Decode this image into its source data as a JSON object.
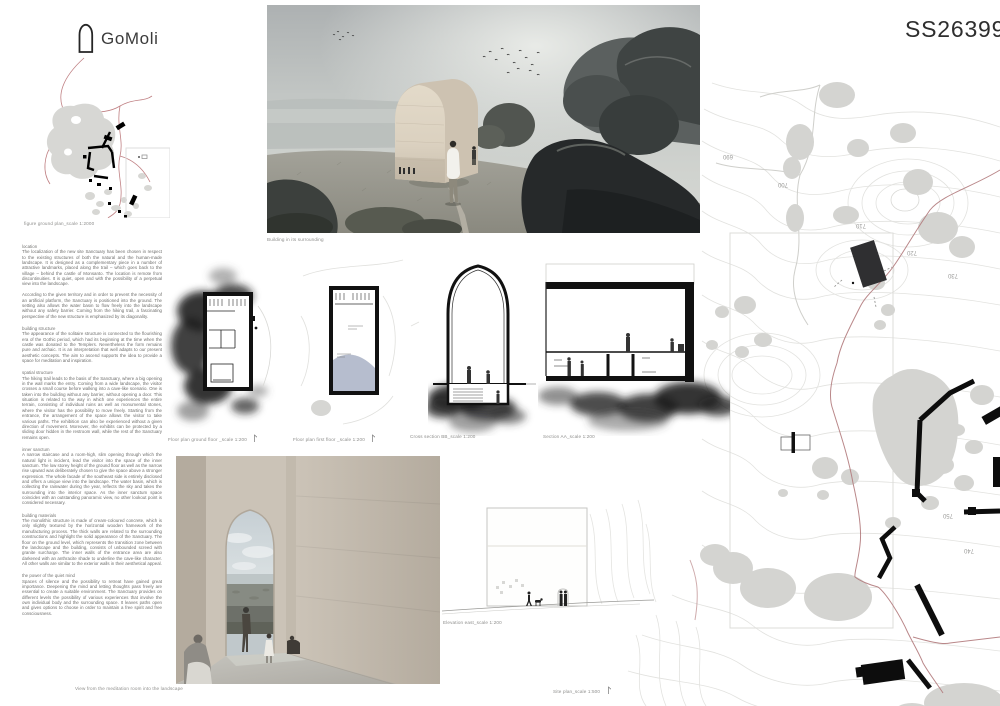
{
  "header": {
    "logo_text": "GoMoli",
    "entry_code": "SS26399"
  },
  "figure_ground": {
    "caption": "figure ground plan_scale 1:2000"
  },
  "main_render": {
    "caption": "Building in its surrounding"
  },
  "interior_render": {
    "caption": "View from the meditation room into the landscape"
  },
  "drawings": {
    "ground_floor_caption": "Floor plan ground floor _scale 1:200",
    "first_floor_caption": "Floor plan first floor _scale 1:200",
    "cross_section_caption": "Cross section BB_scale 1:200",
    "long_section_caption": "Section AA_scale 1:200",
    "elevation_caption": "Elevation east_scale 1:200"
  },
  "site_plan": {
    "caption": "Site plan_scale 1:500",
    "contour_labels": [
      "690",
      "700",
      "710",
      "720",
      "730",
      "740",
      "750"
    ]
  },
  "text_columns": {
    "sections": [
      {
        "heading": "location",
        "body": "The localization of the new site Sanctuary has been chosen in respect to the existing structures of both the natural and the human-made landscape. It is designed as a complementary piece in a number of attractive landmarks, placed along the trail – which goes back to the village – behind the castle of Monsanto. The location is remote from discontinuities. It is quiet, open and with the possibility of a perpetual view into the landscape.\n\nAccording to the given territory and in order to prevent the necessity of an artificial platform, the Sanctuary is positioned into the ground. The setting also allows the water basin to flow freely into the landscape without any safety barrier. Coming from the hiking trail, a fascinating perspective of the new structure is emphasized by its diagonality."
      },
      {
        "heading": "building structure",
        "body": "The appearance of the solitaire structure is connected to the flourishing era of the Gothic period, which had its beginning at the time when the castle was donated to the Templers. Nevertheless the form remains pure and archaic. It is an interpretation that well adapts to our present aesthetic concepts. The aim to ascend supports the idea to provide a space for meditation and inspiration."
      },
      {
        "heading": "spatial structure",
        "body": "The hiking trail leads to the basis of the Sanctuary, where a big opening in the wall marks the entry. Coming from a wide landscape, the visitor crosses a small course before walking into a cave-like scenario. One is taken into the building without any barrier, without opening a door. This situation is related to the way in which one experiences the entire terrain, consisting of individual ruins as well as monumental stones, where the visitor has the possibility to move freely. Starting from the entrance, the arrangement of the space allows the visitor to take various paths. The exhibition can also be experienced without a given direction of movement. Moreover, the exhibits can be protected by a sliding door hidden in the restroom wall, while the rest of the Sanctuary remains open."
      },
      {
        "heading": "inner sanctum",
        "body": "A narrow staircase and a room-high, slim opening through which the natural light is incident, lead the visitor into the space of the inner sanctum. The low storey height of the ground floor as well as the narrow rise upward was deliberately chosen to give the space above a stronger expression. The whole facade of the southeast side is entirely disclosed and offers a unique view into the landscape. The water basin, which is collecting the rainwater during the year, reflects the sky and takes the surrounding into the interior space. As the inner sanctum space coincides with an outstanding panoramic view, no other lookout point is considered necessary."
      },
      {
        "heading": "building materials",
        "body": "The monolithic structure is made of cream-coloured concrete, which is only slightly textured by the horizontal wooden framework of the manufacturing process. The thick walls are related to the surrounding constructions and highlight the solid appearance of the Sanctuary. The floor on the ground level, which represents the transition zone between the landscape and the building, consists of unbounded screed with granite surcharge. The inner walls of the entrance area are also darkened with an anthracite shade to underline the cave-like character. All other walls are similar to the exterior walls in their aesthetical appeal."
      },
      {
        "heading": "the power of the quiet mind",
        "body": "Spaces of silence and the possibility to retreat have gained great importance. Deepening the mind and letting thoughts pass freely are essential to create a suitable environment. The Sanctuary provides on different levels the possibility of various experiences that involve the own individual body and the surrounding space. It leaves paths open and gives options to choose in order to maintain a free spirit and free consciousness."
      }
    ]
  },
  "colors": {
    "trail_red": "#b27a7c",
    "water_blue": "#a9b2c6",
    "building_cream": "#ddd3c3",
    "charcoal": "#1c1c1e"
  }
}
